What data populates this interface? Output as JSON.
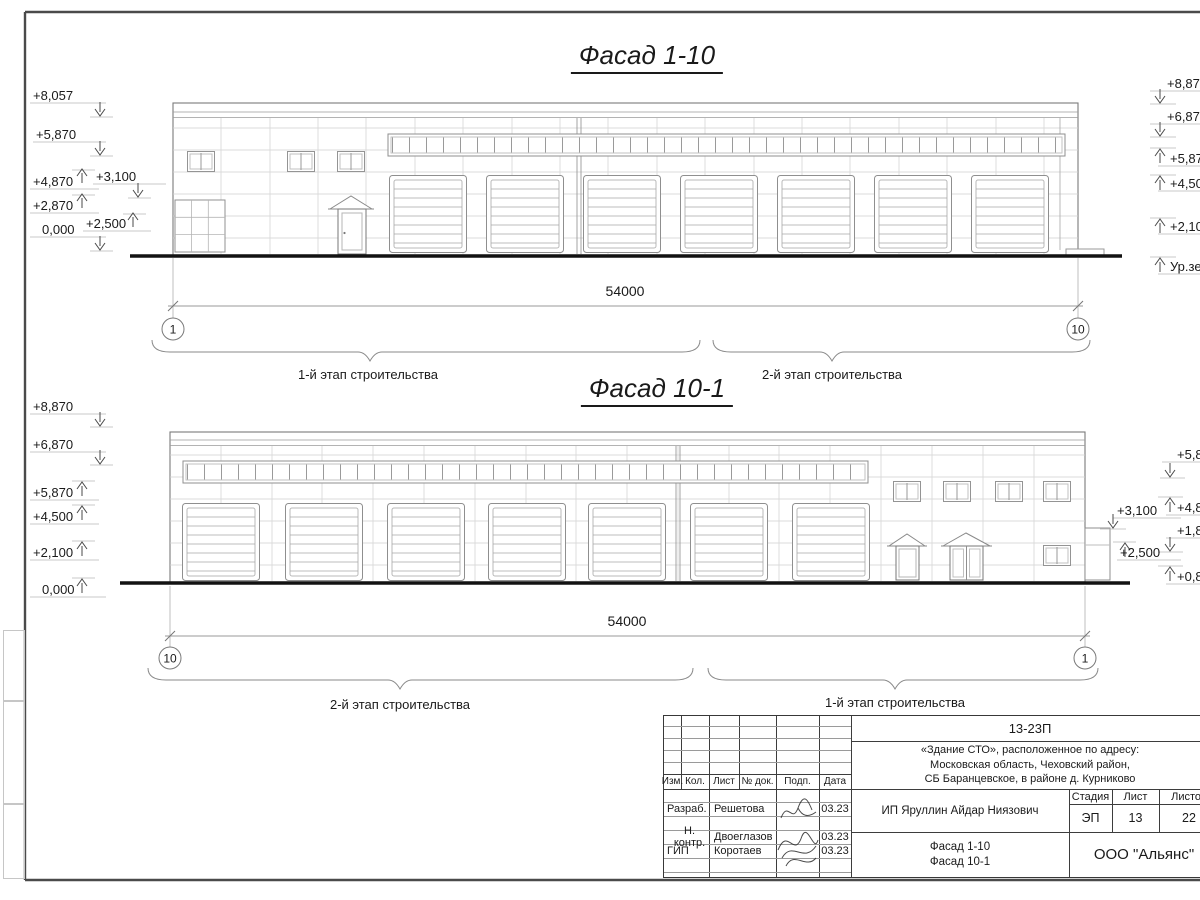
{
  "facade_top": {
    "title": "Фасад 1-10",
    "dimension": "54000",
    "axis_left": "1",
    "axis_right": "10",
    "stage_left": "1-й этап строительства",
    "stage_right": "2-й этап строительства",
    "marks_left": [
      "+8,057",
      "+5,870",
      "+4,870",
      "+3,100",
      "+2,870",
      "+2,500",
      "0,000"
    ],
    "marks_right": [
      "+8,870",
      "+6,870",
      "+5,870",
      "+4,500",
      "+2,100",
      "Ур.земли"
    ]
  },
  "facade_bottom": {
    "title": "Фасад 10-1",
    "dimension": "54000",
    "axis_left": "10",
    "axis_right": "1",
    "stage_left": "2-й этап строительства",
    "stage_right": "1-й этап строительства",
    "marks_left": [
      "+8,870",
      "+6,870",
      "+5,870",
      "+4,500",
      "+2,100",
      "0,000"
    ],
    "marks_inner_right": [
      "+3,100",
      "+2,500"
    ],
    "marks_right": [
      "+5,8",
      "+4,8",
      "+1,8",
      "+0,8"
    ]
  },
  "title_block": {
    "doc_number": "13-23П",
    "address": [
      "«Здание СТО», расположенное по адресу:",
      "Московская область, Чеховский район,",
      "СБ Баранцевское, в районе д. Курниково"
    ],
    "client": "ИП Яруллин Айдар Ниязович",
    "sheet_name1": "Фасад 1-10",
    "sheet_name2": "Фасад 10-1",
    "company": "ООО \"Альянс\"",
    "cols": {
      "izm": "Изм.",
      "kol": "Кол.",
      "list": "Лист",
      "ndok": "№ док.",
      "podp": "Подп.",
      "data": "Дата"
    },
    "stage_header": {
      "stadia": "Стадия",
      "list": "Лист",
      "listov": "Листов"
    },
    "stage_values": {
      "stadia": "ЭП",
      "list": "13",
      "listov": "22"
    },
    "rows": [
      {
        "role": "Разраб.",
        "name": "Решетова",
        "date": "03.23"
      },
      {
        "role": "Н. контр.",
        "name": "Двоеглазов",
        "date": "03.23"
      },
      {
        "role": "ГИП",
        "name": "Коротаев",
        "date": "03.23"
      }
    ]
  }
}
